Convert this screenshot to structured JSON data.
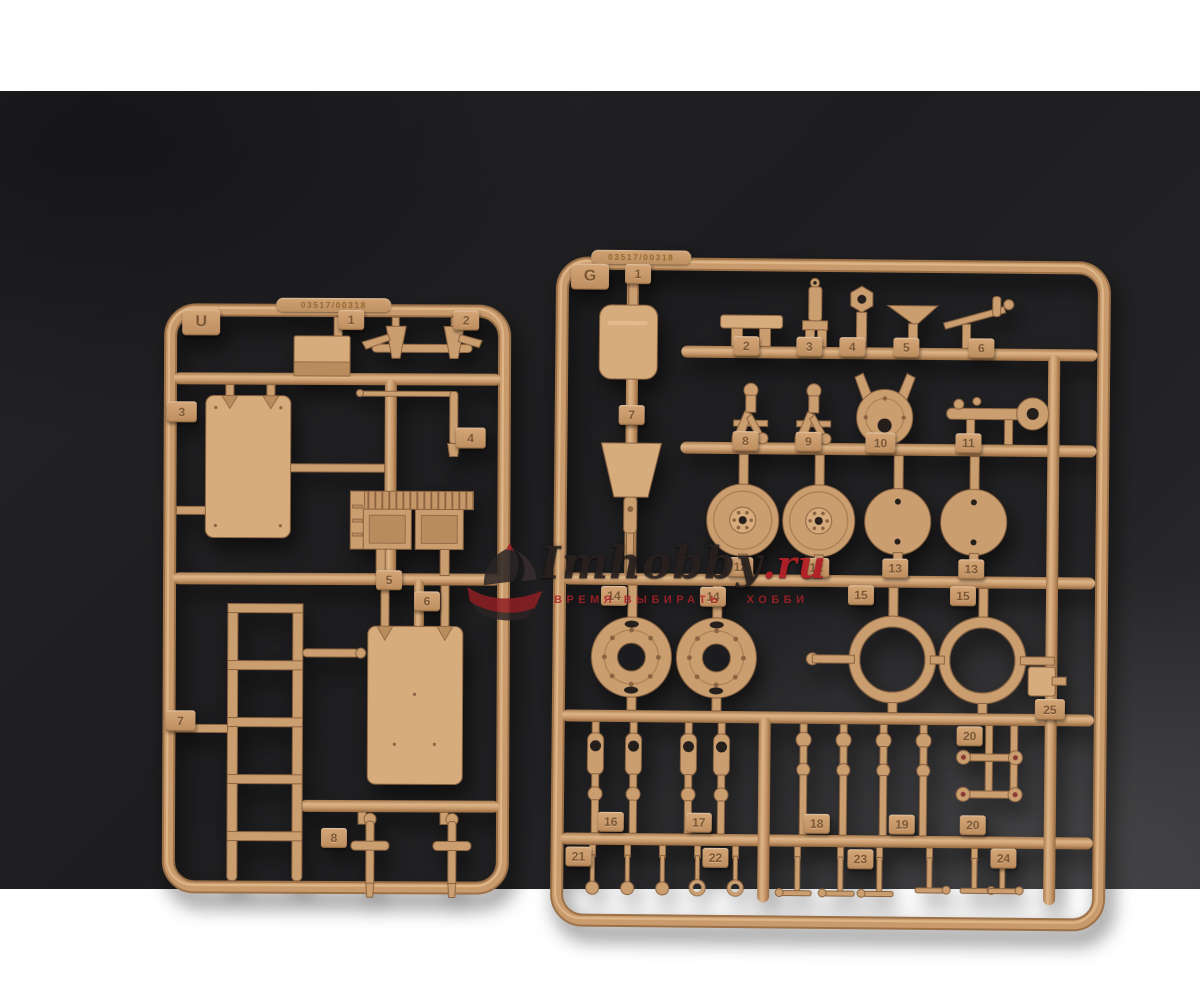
{
  "photo": {
    "background_color": "#202022",
    "plastic_color": "#c89a6c",
    "watermark": {
      "logo": "ship-logo",
      "brand": "Imhobby",
      "tld": ".ru",
      "subtitle_left": "ВРЕМЯ ВЫБИРАТЬ",
      "subtitle_right": "ХОББИ",
      "accent_color": "#ba2228"
    },
    "sprues": [
      {
        "letter": "U",
        "embossed_code": "03517/00318",
        "tags": [
          "1",
          "2",
          "3",
          "4",
          "5",
          "6",
          "7",
          "8"
        ]
      },
      {
        "letter": "G",
        "embossed_code": "03517/00318",
        "tags": [
          "1",
          "2",
          "3",
          "4",
          "5",
          "6",
          "7",
          "8",
          "9",
          "10",
          "11",
          "12",
          "12",
          "13",
          "13",
          "14",
          "14",
          "15",
          "15",
          "25",
          "16",
          "17",
          "18",
          "19",
          "20",
          "20",
          "21",
          "22",
          "23",
          "24"
        ]
      }
    ]
  }
}
